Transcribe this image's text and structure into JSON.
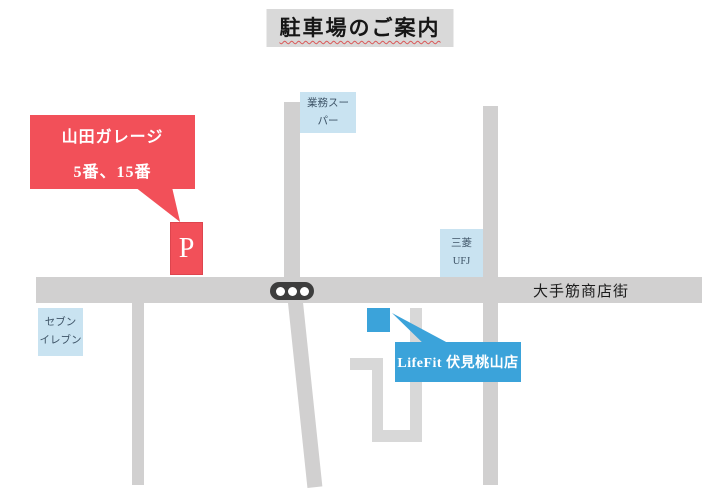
{
  "title": {
    "text": "駐車場のご案内"
  },
  "colors": {
    "road": "#d1d0d0",
    "alley": "#d8d8d8",
    "title_bg": "#d9d9d9",
    "red": "#f25059",
    "blue": "#3ba3da",
    "light_blue": "#c9e3f1",
    "box_text": "#3e5467",
    "street_text": "#1c1c1c",
    "traffic_light": "#3d3d3d"
  },
  "parking": {
    "callout_line1": "山田ガレージ",
    "callout_line2": "5番、15番",
    "marker_label": "P"
  },
  "landmarks": {
    "gyomu_super": {
      "line1": "業務スー",
      "line2": "パー"
    },
    "mitsubishi_ufj": {
      "line1": "三菱",
      "line2": "UFJ"
    },
    "seven_eleven": {
      "line1": "セブン",
      "line2": "イレブン"
    }
  },
  "street": {
    "label": "大手筋商店街"
  },
  "store": {
    "callout_label": "LifeFit 伏見桃山店"
  },
  "traffic_light": {
    "dot_count": 3
  }
}
